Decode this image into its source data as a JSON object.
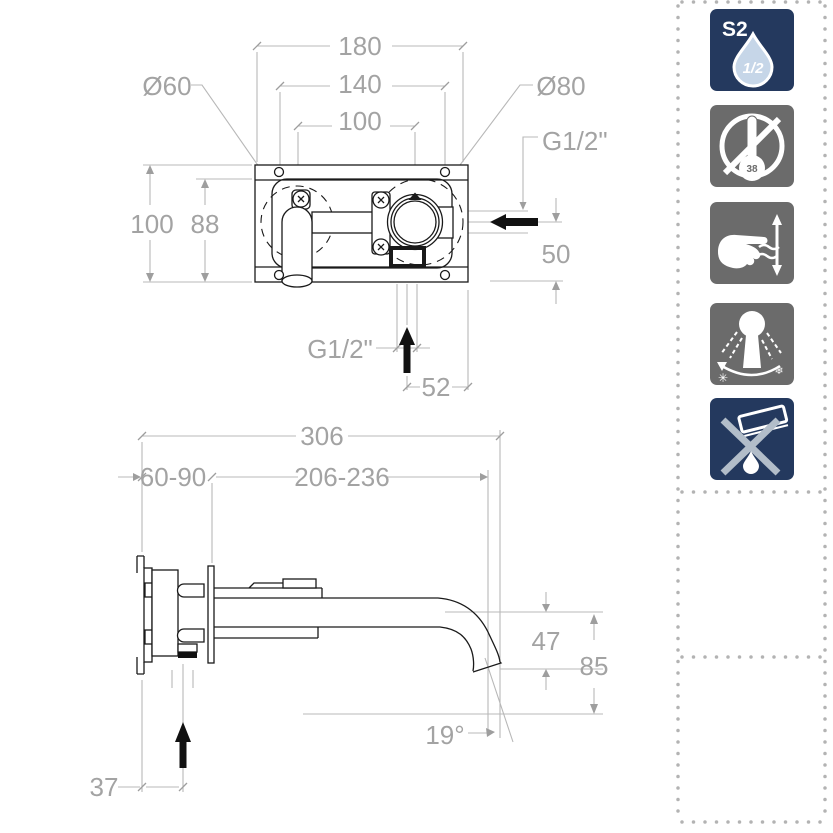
{
  "top_view": {
    "dim_overall_width": "180",
    "dim_hole_spacing": "140",
    "dim_center_spacing": "100",
    "label_rosette_small": "Ø60",
    "label_rosette_large": "Ø80",
    "label_inlet_thread": "G1/2\"",
    "dim_overall_height": "100",
    "dim_inner_height": "88",
    "dim_inlet_drop": "50",
    "label_outlet_thread": "G1/2\"",
    "dim_outlet_offset": "52"
  },
  "side_view": {
    "dim_total_length": "306",
    "dim_wall_adjust": "60-90",
    "dim_spout_reach": "206-236",
    "dim_spout_drop": "47",
    "dim_overall_height": "85",
    "dim_outlet_angle": "19°",
    "dim_inlet_offset": "37"
  },
  "icon_panel": {
    "icons": [
      {
        "id": "flow-class",
        "label": "S2",
        "fraction": "1/2",
        "style": "navy"
      },
      {
        "id": "no-thermostatic-limit",
        "bulb_value": "38",
        "style": "gray"
      },
      {
        "id": "manual-flow-adjust",
        "style": "gray"
      },
      {
        "id": "adjustable-spray-angle",
        "style": "gray"
      },
      {
        "id": "no-aggressive-cleaners",
        "style": "navy"
      }
    ]
  },
  "colors": {
    "navy": "#24395e",
    "icon_gray": "#6b6b6b",
    "dim_text": "#a3a3a3",
    "dim_line": "#b8b8b8",
    "drawing_line": "#1a1a1a",
    "dot_border": "#b3b3b3",
    "cross_gray": "#b2bdc9",
    "drop_fill": "#c6d6e8"
  }
}
